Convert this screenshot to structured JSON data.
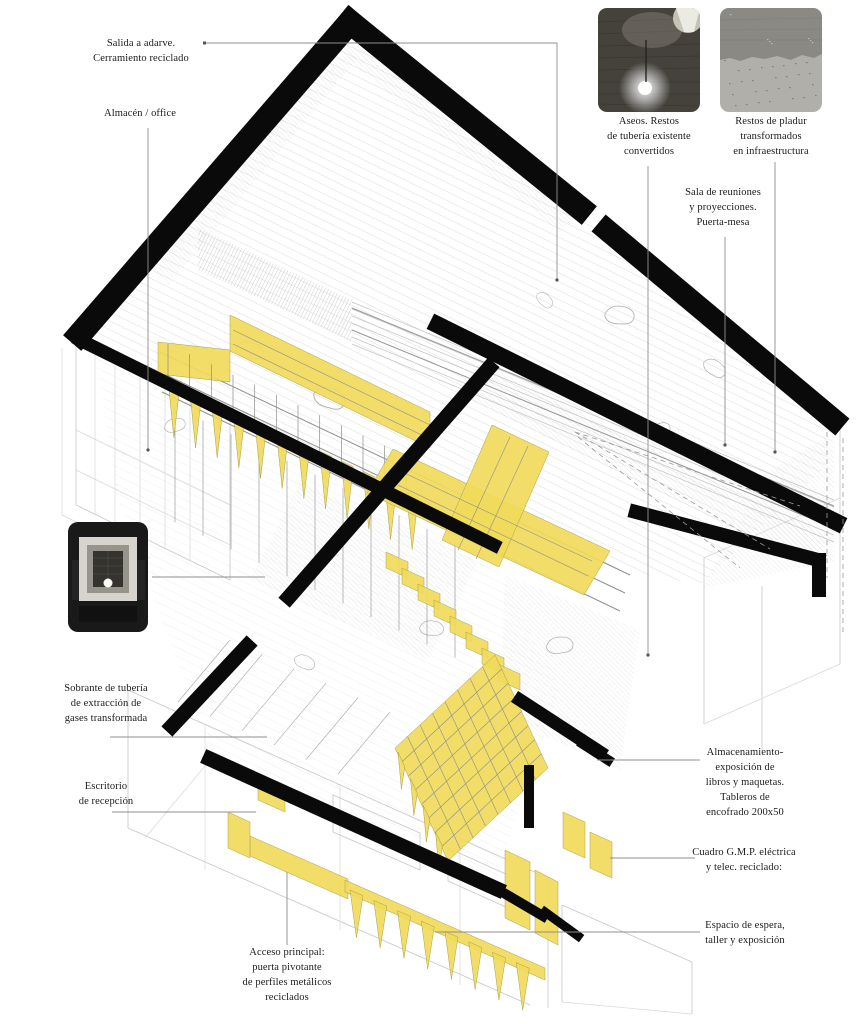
{
  "labels": {
    "salida": {
      "lines": [
        "Salida a adarve.",
        "Cerramiento reciclado"
      ]
    },
    "almacen": {
      "lines": [
        "Almacén / office"
      ]
    },
    "aseos": {
      "lines": [
        "Aseos. Restos",
        "de tubería existente",
        "convertidos"
      ]
    },
    "pladur": {
      "lines": [
        "Restos de pladur",
        "transformados",
        "en infraestructura"
      ]
    },
    "sala": {
      "lines": [
        "Sala de reuniones",
        "y proyecciones.",
        "Puerta-mesa"
      ]
    },
    "sobrante": {
      "lines": [
        "Sobrante de tubería",
        "de extracción de",
        "gases transformada"
      ]
    },
    "escritorio": {
      "lines": [
        "Escritorio",
        "de recepción"
      ]
    },
    "almacenamiento": {
      "lines": [
        "Almacenamiento-",
        "exposición de",
        "libros y maquetas.",
        "Tableros de",
        "encofrado 200x50"
      ]
    },
    "cuadro": {
      "lines": [
        "Cuadro G.M.P. eléctrica",
        "y telec. reciclado:"
      ]
    },
    "espera": {
      "lines": [
        "Espacio de espera,",
        "taller y exposición"
      ]
    },
    "acceso": {
      "lines": [
        "Acceso principal:",
        "puerta pivotante",
        "de perfiles metálicos",
        "reciclados"
      ]
    }
  },
  "colors": {
    "highlight_yellow": "#f0da5a",
    "wall_black": "#0a0a0a",
    "leader_gray": "#8f8f8f",
    "text_ink": "#1b1b1b"
  }
}
